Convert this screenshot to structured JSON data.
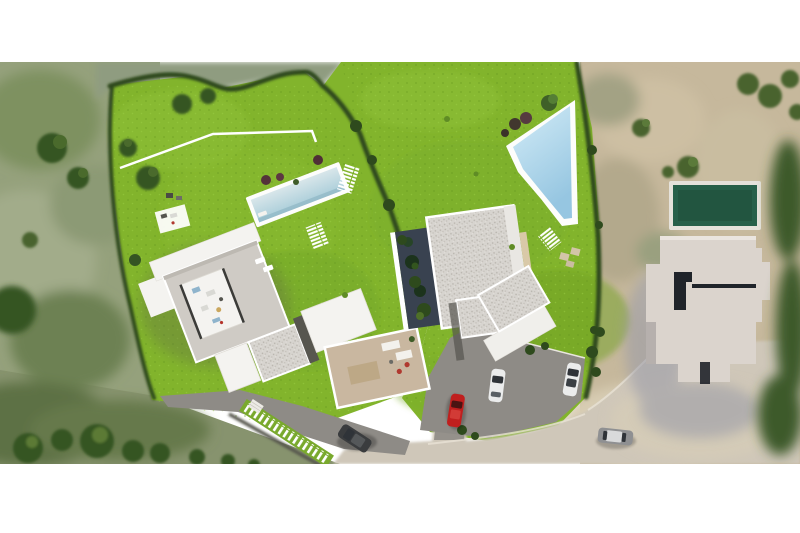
{
  "scene": {
    "title": "aerial-site-plan-render",
    "description": "top-down architectural render: two bright-green plots each with a modern flat-roof villa and pool, olive scrubland left, beige neighbour plot right with house and dark green pool, access road with parked cars at bottom",
    "counts": {
      "plots": 2,
      "villas": 2,
      "swimming_pools": 3,
      "cars": 5
    },
    "objects": [
      "left-plot-lawn",
      "right-plot-lawn",
      "villa-1",
      "villa-2",
      "pool-1-long",
      "pool-2-wedge",
      "neighbour-house",
      "neighbour-pool-green",
      "access-road",
      "driveway-1",
      "driveway-2",
      "car-red",
      "car-white-1",
      "car-white-2",
      "car-dark-suv",
      "car-silver",
      "boundary-hedges",
      "stepping-stone-paths",
      "olive-terrain-left",
      "beige-terrain-right"
    ]
  },
  "palette": {
    "white": "#ffffff",
    "grass": "#82b42c",
    "grassLight": "#93c63a",
    "grassDark": "#6f9f26",
    "hedge": "#2f4a1b",
    "treeDark": "#355423",
    "treeOlive": "#49632e",
    "terrainLeft": "#95a17c",
    "terrainRight": "#c6b89c",
    "sage": "#8f9c80",
    "road": "#cfc7b9",
    "asphalt": "#8e8b86",
    "wall": "#57564e",
    "poolDeck": "#fdfdfb",
    "pool1WaterA": "#d8e6ea",
    "pool1WaterB": "#a9cdd9",
    "pool2WaterA": "#d3ecf7",
    "pool2WaterB": "#96c6e1",
    "pool3Water": "#27604a",
    "pool3Border": "#e5e2db",
    "roofGreige": "#cfcbc5",
    "roofWhite": "#f4f3f0",
    "roofGravel": "#d7d4cf",
    "terrace": "#c9b7a0",
    "darkPatio": "#394250",
    "neighborRoof": "#dbd4cd",
    "neighborShadow": "#9b9ca8",
    "notch": "#20242a",
    "carRed": "#c01f1e",
    "carWhite": "#ebecec",
    "carDark": "#3a3c3e",
    "carSilver": "#8f9092",
    "glass": "#2f3338"
  }
}
